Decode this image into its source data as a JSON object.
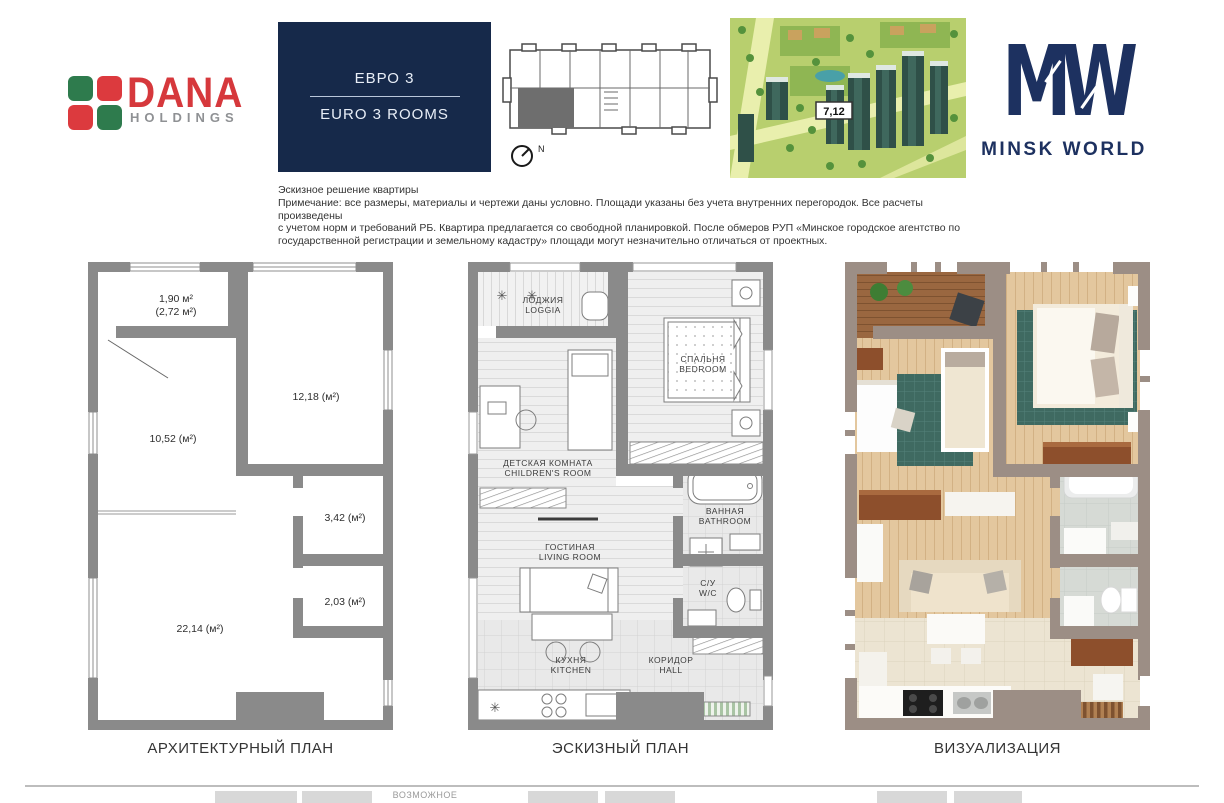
{
  "header": {
    "dana_logo": {
      "name": "DANA",
      "subtitle": "HOLDINGS"
    },
    "unit_type": {
      "ru": "ЕВРО 3",
      "en": "EURO 3 ROOMS"
    },
    "key_plan": {
      "compass_label": "N"
    },
    "aerial": {
      "building_label": "7,12"
    },
    "brand": {
      "monogram": "MW",
      "name": "MINSK WORLD"
    }
  },
  "disclaimer": {
    "title": "Эскизное решение квартиры",
    "lines": [
      "Примечание: все размеры, материалы и чертежи даны условно. Площади указаны без учета внутренних перегородок. Все расчеты произведены",
      "с учетом норм и требований РБ. Квартира предлагается со свободной планировкой. После обмеров РУП «Минское городское агентство по",
      "государственной регистрации и земельному кадастру» площади могут незначительно отличаться от проектных."
    ]
  },
  "architectural_plan": {
    "caption": "АРХИТЕКТУРНЫЙ ПЛАН",
    "areas": {
      "loggia": "1,90 м²",
      "loggia_total": "(2,72 м²)",
      "bedroom": "12,18 (м²)",
      "children_room": "10,52 (м²)",
      "bathroom": "3,42 (м²)",
      "wc": "2,03 (м²)",
      "living_kitchen": "22,14 (м²)"
    }
  },
  "sketch_plan": {
    "caption": "ЭСКИЗНЫЙ ПЛАН",
    "rooms": {
      "loggia_ru": "ЛОДЖИЯ",
      "loggia_en": "LOGGIA",
      "bedroom_ru": "СПАЛЬНЯ",
      "bedroom_en": "BEDROOM",
      "children_ru": "ДЕТСКАЯ КОМНАТА",
      "children_en": "CHILDREN'S ROOM",
      "bathroom_ru": "ВАННАЯ",
      "bathroom_en": "BATHROOM",
      "living_ru": "ГОСТИНАЯ",
      "living_en": "LIVING ROOM",
      "wc_ru": "С/У",
      "wc_en": "W/C",
      "kitchen_ru": "КУХНЯ",
      "kitchen_en": "KITCHEN",
      "hall_ru": "КОРИДОР",
      "hall_en": "HALL"
    }
  },
  "visualization": {
    "caption": "ВИЗУАЛИЗАЦИЯ"
  },
  "footer": {
    "partial_label": "ВОЗМОЖНОЕ"
  },
  "symbols": {
    "star": "✳"
  },
  "colors": {
    "brand_navy": "#16294a",
    "dana_red": "#d6383c",
    "dana_green": "#2e7b4d",
    "wall_gray": "#8a8a8a",
    "wall_taupe": "#9c8e85",
    "rug_teal": "#3f6a61",
    "wood": "#e3c79e"
  }
}
